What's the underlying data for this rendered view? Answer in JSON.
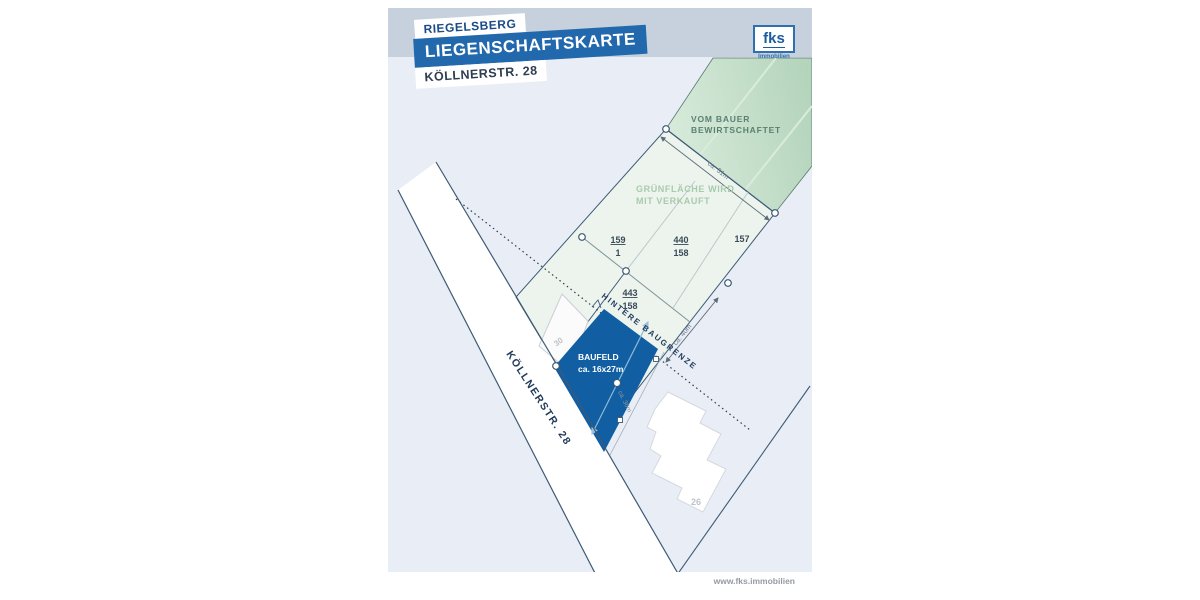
{
  "header": {
    "municipality": "RIEGELSBERG",
    "map_type": "LIEGENSCHAFTSKARTE",
    "address": "KÖLLNERSTR. 28"
  },
  "logo": {
    "name": "fks",
    "subtitle": "Immobilien"
  },
  "footer": {
    "website": "www.fks.immobilien"
  },
  "map": {
    "labels": {
      "farmed_1": "VOM BAUER",
      "farmed_2": "BEWIRTSCHAFTET",
      "green_1": "GRÜNFLÄCHE WIRD",
      "green_2": "MIT VERKAUFT",
      "building_line": "HINTERE BAUGRENZE",
      "baufeld": "BAUFELD",
      "baufeld_size": "ca. 16x27m",
      "street": "KÖLLNERSTR. 28",
      "house_30": "30",
      "house_26": "26"
    },
    "dims": {
      "top": "ca. 31m",
      "right": "ca. 40m",
      "front": "ca. 36m"
    },
    "parcels": [
      {
        "num": "159",
        "den": "1"
      },
      {
        "num": "440",
        "den": "158"
      },
      {
        "num": "157",
        "den": ""
      },
      {
        "num": "443",
        "den": "158"
      }
    ],
    "colors": {
      "brand_blue": "#2268ad",
      "baufeld_blue": "#115fa2",
      "header_band": "#c7d0dd",
      "map_background": "#e9edf6",
      "farmed_green": "#b9d8c1",
      "parcel_green": "#edf4ee"
    }
  }
}
